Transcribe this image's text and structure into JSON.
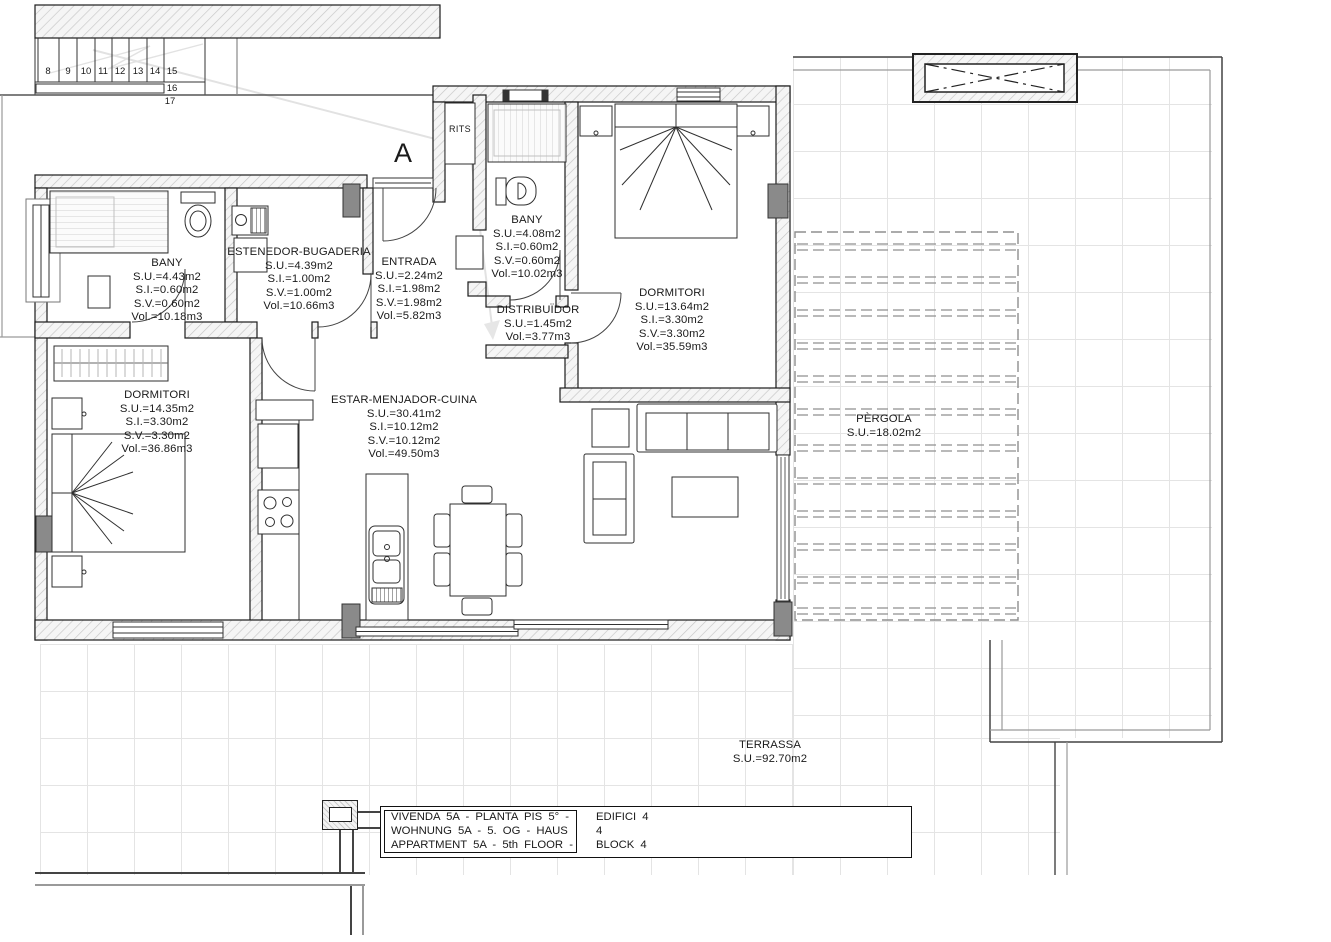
{
  "colors": {
    "ink": "#1a1a1a",
    "wall_hatch": "#c6c6c6",
    "column_gray": "#8a8a8a",
    "grid_line": "#e4e4e4",
    "pergola_dash": "#8f8f8f"
  },
  "plan": {
    "section_label": "A",
    "shaft_label": "RITS"
  },
  "stairs": {
    "numbers": [
      "8",
      "9",
      "10",
      "11",
      "12",
      "13",
      "14",
      "15",
      "16",
      "17"
    ]
  },
  "rooms": {
    "bany_left": {
      "name": "BANY",
      "stats": [
        "S.U.=4.43m2",
        "S.I.=0.60m2",
        "S.V.=0.60m2",
        "Vol.=10.18m3"
      ]
    },
    "estenedor": {
      "name": "ESTENEDOR-BUGADERIA",
      "stats": [
        "S.U.=4.39m2",
        "S.I.=1.00m2",
        "S.V.=1.00m2",
        "Vol.=10.66m3"
      ]
    },
    "entrada": {
      "name": "ENTRADA",
      "stats": [
        "S.U.=2.24m2",
        "S.I.=1.98m2",
        "S.V.=1.98m2",
        "Vol.=5.82m3"
      ]
    },
    "bany_top": {
      "name": "BANY",
      "stats": [
        "S.U.=4.08m2",
        "S.I.=0.60m2",
        "S.V.=0.60m2",
        "Vol.=10.02m3"
      ]
    },
    "dormitori_right": {
      "name": "DORMITORI",
      "stats": [
        "S.U.=13.64m2",
        "S.I.=3.30m2",
        "S.V.=3.30m2",
        "Vol.=35.59m3"
      ]
    },
    "distribuidor": {
      "name": "DISTRIBUÏDOR",
      "stats": [
        "S.U.=1.45m2",
        "Vol.=3.77m3"
      ]
    },
    "dormitori_left": {
      "name": "DORMITORI",
      "stats": [
        "S.U.=14.35m2",
        "S.I.=3.30m2",
        "S.V.=3.30m2",
        "Vol.=36.86m3"
      ]
    },
    "estar": {
      "name": "ESTAR-MENJADOR-CUINA",
      "stats": [
        "S.U.=30.41m2",
        "S.I.=10.12m2",
        "S.V.=10.12m2",
        "Vol.=49.50m3"
      ]
    },
    "pergola": {
      "name": "PÈRGOLA",
      "stats": [
        "S.U.=18.02m2"
      ]
    },
    "terrassa": {
      "name": "TERRASSA",
      "stats": [
        "S.U.=92.70m2"
      ]
    }
  },
  "title_block": {
    "rows": [
      {
        "left": "VIVENDA 5A - PLANTA PIS 5° -",
        "right": "EDIFICI 4"
      },
      {
        "left": "WOHNUNG 5A - 5. OG - HAUS",
        "right": "4"
      },
      {
        "left": "APPARTMENT 5A - 5th FLOOR -",
        "right": "BLOCK 4"
      }
    ]
  }
}
